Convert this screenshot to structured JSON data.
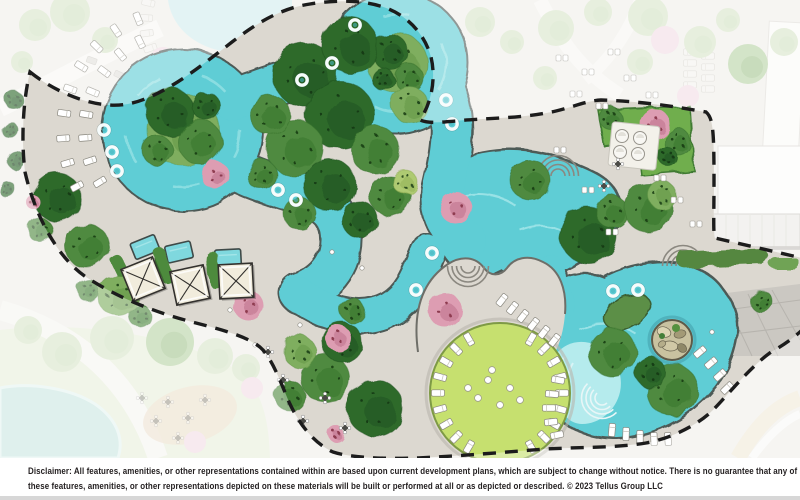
{
  "footer": {
    "disclaimer_line1": "Disclaimer: All features, amenities, or other representations contained within are based upon current development plans, which are subject to change without notice. There is no guarantee that any of",
    "disclaimer_line2": "these features, amenities, or other representations depicted on these materials will be built or performed at all or as depicted or described. © 2023 Tellus Group LLC"
  },
  "plan": {
    "type": "resort-amenity-site-plan-rendering",
    "icons": [
      "lazy-river",
      "pool-deck",
      "tree-canopy-icon",
      "pink-flowering-tree-icon",
      "inner-tube-icon",
      "lounge-chair-icon",
      "cabana-icon",
      "plunge-pool",
      "event-lawn",
      "grotto-island",
      "planted-island",
      "entry-steps-icon",
      "daybed-icon",
      "dining-table-icon",
      "pavilion-canopy",
      "property-boundary-dashed-line",
      "pond"
    ]
  },
  "palette": {
    "water": "#5ecdd5",
    "water_edge": "#4e5a57",
    "water_light": "#a8e7ea",
    "water_beach": "#bfeef0",
    "deck": "#dcd8d0",
    "outside": "#f0efeb",
    "paver": "#cbc8c2",
    "tree_dark": "#2e6b2b",
    "tree_mid": "#4f8a3f",
    "tree_light": "#7fae5e",
    "tree_gap": "#aeca72",
    "pink": "#dd9db2",
    "pink_core": "#8e3b50",
    "lawn": "#c6e06f",
    "lawn_edge": "#7e9a45",
    "hedge": "#4e8a3c",
    "boundary": "#1c1c1c",
    "band": "#ffffff",
    "text": "#252122",
    "pond": "#cbe7e2",
    "faded_green": "#d9e6ca",
    "faded_pink": "#f2dde5",
    "faded_pool": "#cdebee"
  }
}
